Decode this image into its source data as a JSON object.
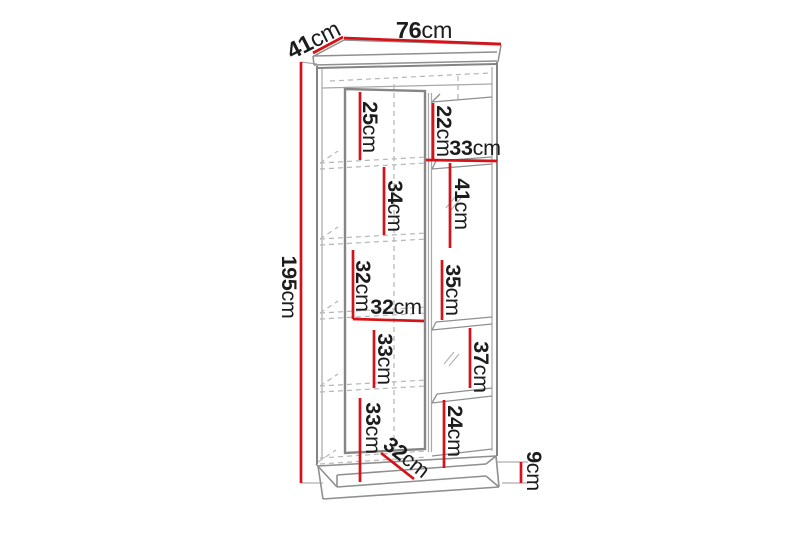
{
  "diagram": {
    "type": "furniture-dimension-drawing",
    "unit": "cm",
    "accent_color": "#d41217",
    "line_color": "#8f8f8f",
    "measurements": {
      "width": {
        "num": "76",
        "unit": "cm"
      },
      "depth": {
        "num": "41",
        "unit": "cm"
      },
      "height": {
        "num": "195",
        "unit": "cm"
      },
      "left_top": {
        "num": "25",
        "unit": "cm"
      },
      "left_2": {
        "num": "34",
        "unit": "cm"
      },
      "left_3": {
        "num": "32",
        "unit": "cm"
      },
      "left_width": {
        "num": "32",
        "unit": "cm"
      },
      "left_4": {
        "num": "33",
        "unit": "cm"
      },
      "left_bottom": {
        "num": "33",
        "unit": "cm"
      },
      "inner_depth": {
        "num": "32",
        "unit": "cm"
      },
      "right_top": {
        "num": "22",
        "unit": "cm"
      },
      "right_width": {
        "num": "33",
        "unit": "cm"
      },
      "right_2": {
        "num": "41",
        "unit": "cm"
      },
      "right_3": {
        "num": "35",
        "unit": "cm"
      },
      "right_4": {
        "num": "37",
        "unit": "cm"
      },
      "right_bottom": {
        "num": "24",
        "unit": "cm"
      },
      "plinth": {
        "num": "9",
        "unit": "cm"
      }
    }
  }
}
